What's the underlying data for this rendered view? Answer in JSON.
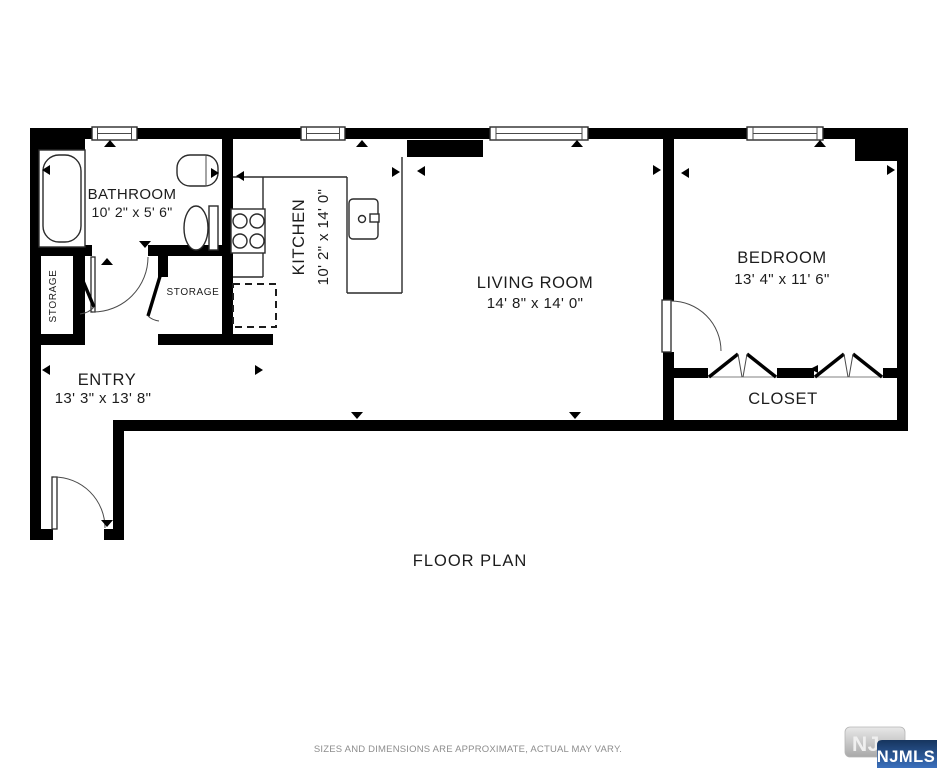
{
  "page": {
    "background": "#ffffff",
    "wall_color": "#000000",
    "line_color": "#2a2a2a",
    "text_color": "#1c1c1c"
  },
  "title": {
    "label": "FLOOR PLAN"
  },
  "rooms": {
    "bathroom": {
      "name": "BATHROOM",
      "dims": "10' 2\" x 5' 6\""
    },
    "kitchen": {
      "name": "KITCHEN",
      "dims": "10' 2\" x 14' 0\""
    },
    "living_room": {
      "name": "LIVING ROOM",
      "dims": "14' 8\" x 14' 0\""
    },
    "bedroom": {
      "name": "BEDROOM",
      "dims": "13' 4\" x 11' 6\""
    },
    "entry": {
      "name": "ENTRY",
      "dims": "13' 3\" x 13' 8\""
    },
    "closet": {
      "name": "CLOSET"
    },
    "storage_left": {
      "name": "STORAGE"
    },
    "storage_right": {
      "name": "STORAGE"
    }
  },
  "footer": {
    "disclaimer": "SIZES AND DIMENSIONS ARE APPROXIMATE, ACTUAL MAY VARY."
  },
  "logo": {
    "nj": "NJ",
    "njmls": "NJMLS",
    "blue_dark": "#16355e",
    "blue_light": "#3a6fbc",
    "gray_light": "#e8e8e8",
    "gray_dark": "#a9a9a9"
  }
}
